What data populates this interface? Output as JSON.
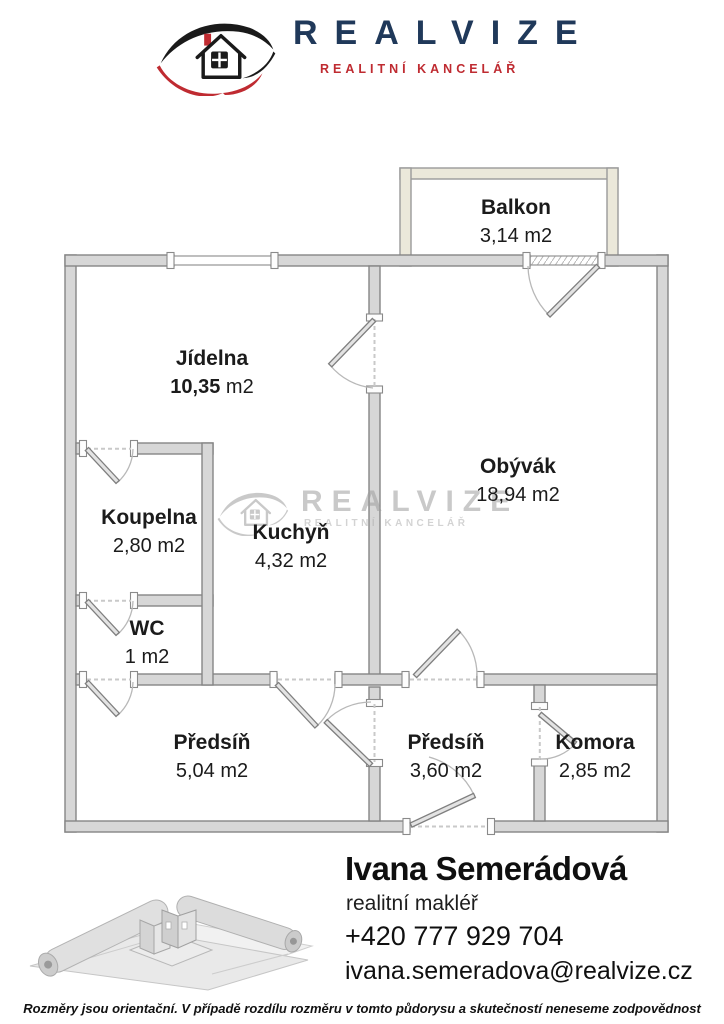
{
  "header": {
    "brand": "REALVIZE",
    "tagline": "REALITNÍ KANCELÁŘ"
  },
  "watermark": {
    "brand": "REALVIZE",
    "tagline": "REALITNÍ KANCELÁŘ"
  },
  "floorplan": {
    "rooms": [
      {
        "id": "balkon",
        "name": "Balkon",
        "area": "3,14 m2"
      },
      {
        "id": "jidelna",
        "name": "Jídelna",
        "area_value": "10,35",
        "area_unit": " m2"
      },
      {
        "id": "obyvak",
        "name": "Obývák",
        "area": "18,94 m2"
      },
      {
        "id": "koupelna",
        "name": "Koupelna",
        "area": "2,80 m2"
      },
      {
        "id": "kuchyn",
        "name": "Kuchyň",
        "area": "4,32 m2"
      },
      {
        "id": "wc",
        "name": "WC",
        "area": "1 m2"
      },
      {
        "id": "predsin1",
        "name": "Předsíň",
        "area": "5,04 m2"
      },
      {
        "id": "predsin2",
        "name": "Předsíň",
        "area": "3,60 m2"
      },
      {
        "id": "komora",
        "name": "Komora",
        "area": "2,85 m2"
      }
    ]
  },
  "agent": {
    "name": "Ivana Semerádová",
    "role": "realitní makléř",
    "phone": "+420 777 929 704",
    "email": "ivana.semeradova@realvize.cz"
  },
  "footer": {
    "disclaimer": "Rozměry jsou orientační. V případě rozdílu rozměru v tomto půdorysu a skutečností neneseme zodpovědnost"
  },
  "colors": {
    "brand_navy": "#20395a",
    "brand_red": "#bf2b31",
    "wall_fill": "#d7d7d7",
    "wall_stroke": "#858585",
    "balcony_wall": "#ebe8da",
    "watermark_gray": "#9d9d9d"
  }
}
